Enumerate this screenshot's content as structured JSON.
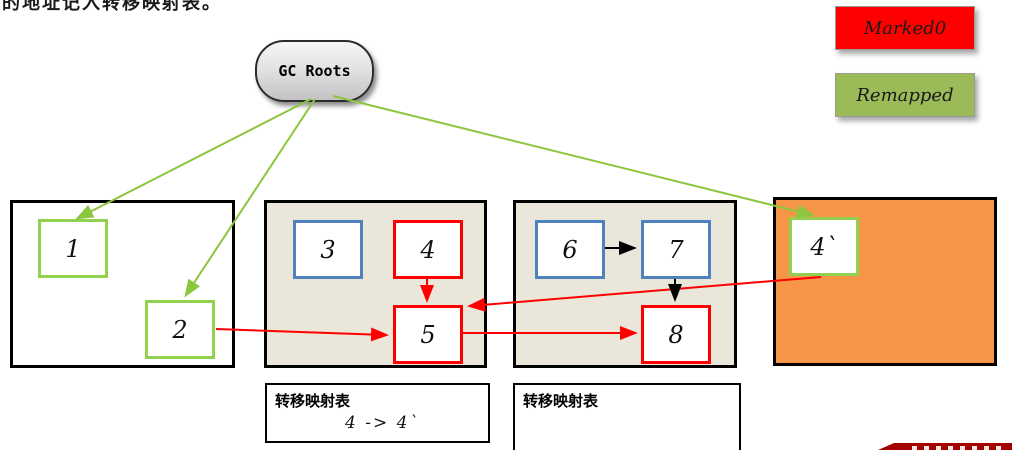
{
  "heading": {
    "text": "的地址记入转移映射表。"
  },
  "gc_roots": {
    "label": "GC Roots"
  },
  "legend": {
    "items": [
      {
        "label": "Marked0",
        "fill": "#FF0000"
      },
      {
        "label": "Remapped",
        "fill": "#9BBB59"
      }
    ]
  },
  "regions": [
    {
      "name": "region-1",
      "fill": "#FFFFFF",
      "boxes": [
        {
          "label": "1"
        },
        {
          "label": "2"
        }
      ]
    },
    {
      "name": "region-2",
      "fill": "#EAE6DA",
      "boxes": [
        {
          "label": "3"
        },
        {
          "label": "4"
        },
        {
          "label": "5"
        }
      ]
    },
    {
      "name": "region-3",
      "fill": "#EAE6DA",
      "boxes": [
        {
          "label": "6"
        },
        {
          "label": "7"
        },
        {
          "label": "8"
        }
      ]
    },
    {
      "name": "region-4",
      "fill": "#F79646",
      "boxes": [
        {
          "label": "4`"
        }
      ]
    }
  ],
  "tables": [
    {
      "title": "转移映射表",
      "mapping": "4 -> 4`"
    },
    {
      "title": "转移映射表",
      "mapping": ""
    }
  ],
  "colors": {
    "marked_red": "#FF0000",
    "remapped_green": "#9BBB59",
    "arrow_green": "#8CC63E",
    "box_green": "#92D050",
    "box_blue": "#4F81BD",
    "box_red": "#FF0000",
    "region_beige": "#EAE6DA",
    "region_orange": "#F79646",
    "banner_red": "#A50000"
  }
}
